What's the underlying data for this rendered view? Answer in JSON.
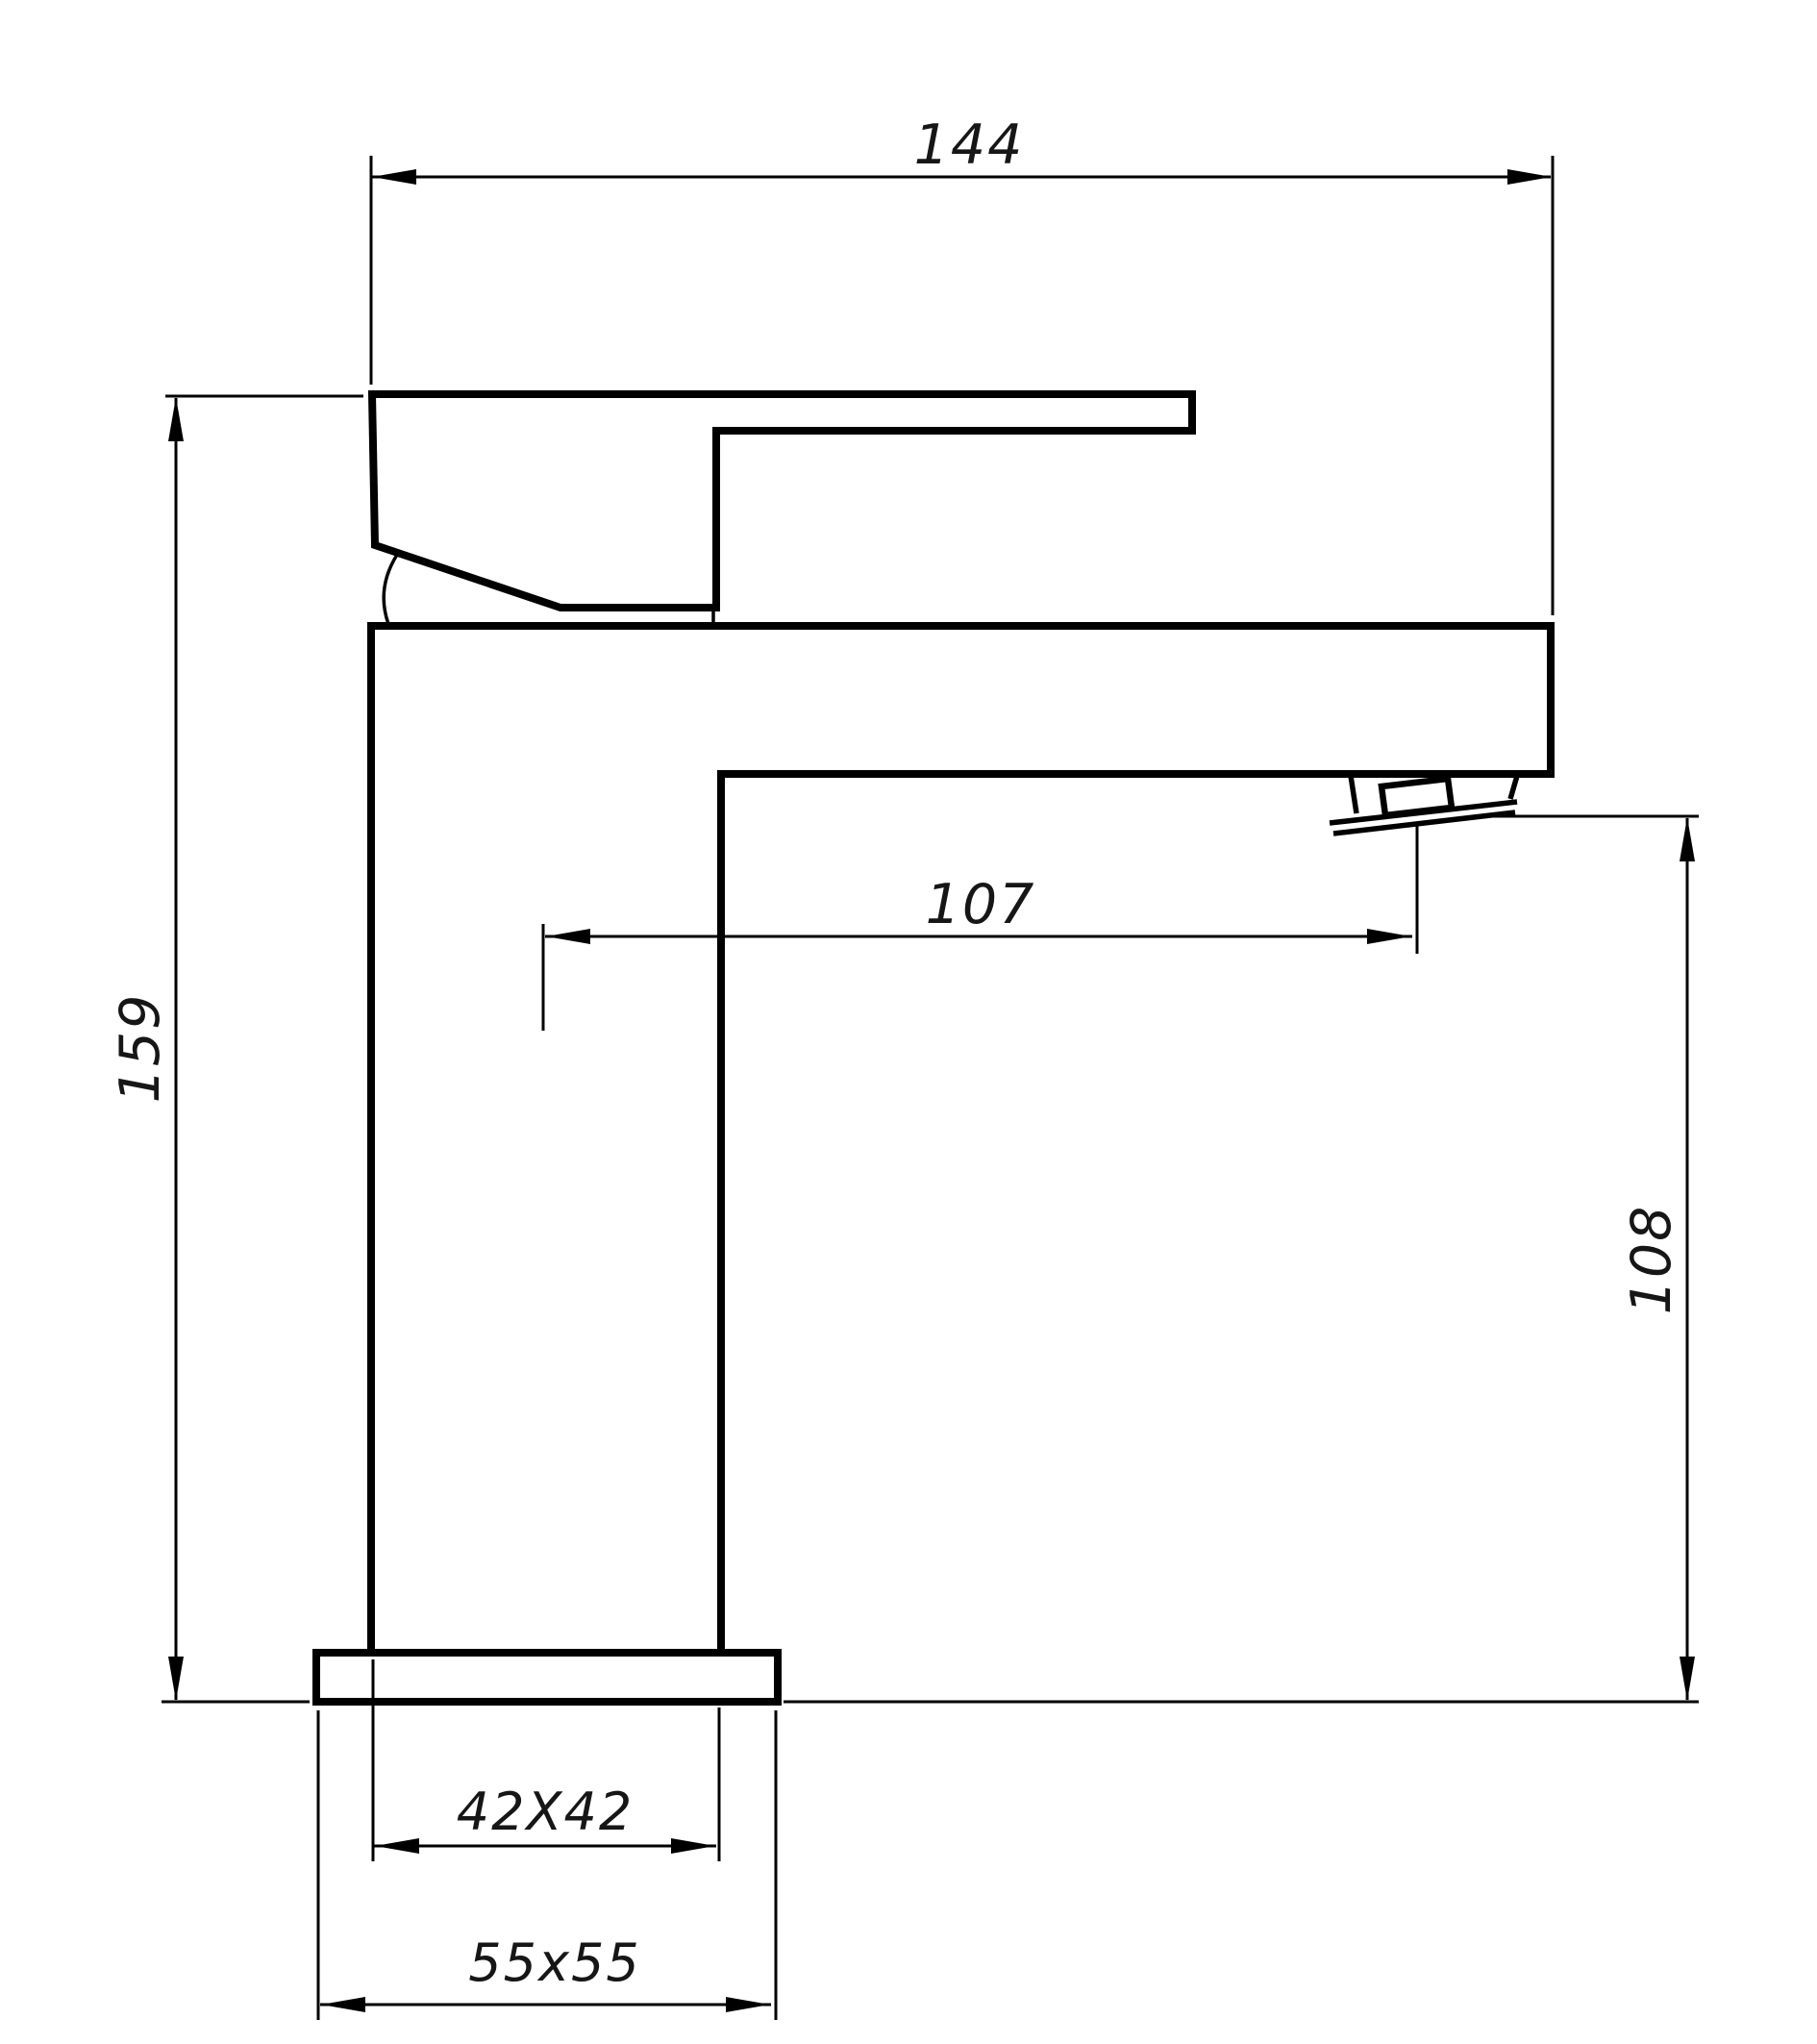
{
  "drawing": {
    "kind": "faucet-dimension-drawing",
    "dimensions": {
      "overall_width": "144",
      "overall_height": "159",
      "spout_reach": "107",
      "spout_outlet_height": "108",
      "body_cross_section": "42X42",
      "base_cross_section": "55x55"
    },
    "colors": {
      "line": "#000000",
      "background": "#ffffff",
      "text": "#161616"
    }
  }
}
